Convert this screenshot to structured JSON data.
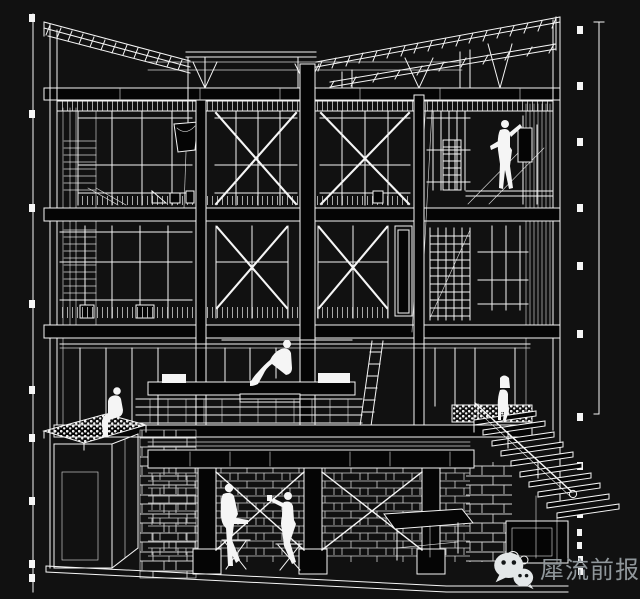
{
  "watermark": {
    "text": "犀流前报",
    "icon": "wechat-icon"
  },
  "palette": {
    "background": "#111111",
    "line": "#f5f5f5",
    "solid_fill": "#050505",
    "hatch": "#cfcfcf",
    "watermark_text": "#90979b",
    "watermark_icon": "#e4e7e8",
    "icon_eye": "#141617"
  }
}
